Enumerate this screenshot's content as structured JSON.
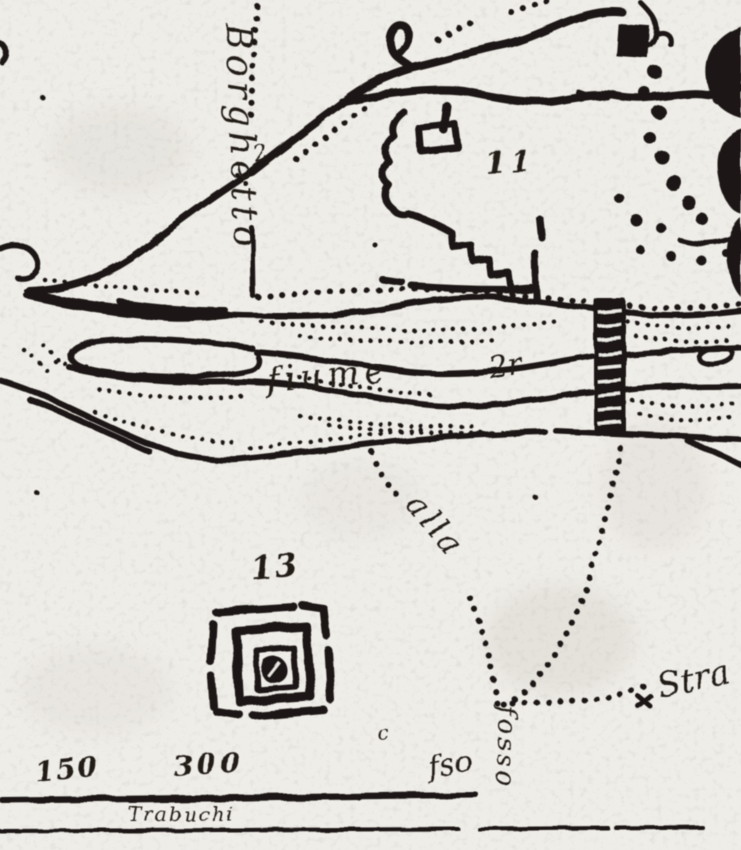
{
  "page": {
    "kind": "scanned hand-drawn historical map",
    "paper_color": "#efede8",
    "ink_color": "#1b1712"
  },
  "labels": {
    "road_name_vertical": "Borghetto",
    "river_name": "fiume",
    "river_flourish": "2r",
    "route_alla": "alla",
    "route_fosso": "fosso",
    "route_fso": "fso",
    "route_strada": "Stra",
    "junction_mark": "2",
    "small_mark": "c"
  },
  "numbers": {
    "site_11": "11",
    "site_13": "13",
    "scale_150": "150",
    "scale_300": "300"
  },
  "scale_bar": {
    "caption": "Trabuchi"
  }
}
